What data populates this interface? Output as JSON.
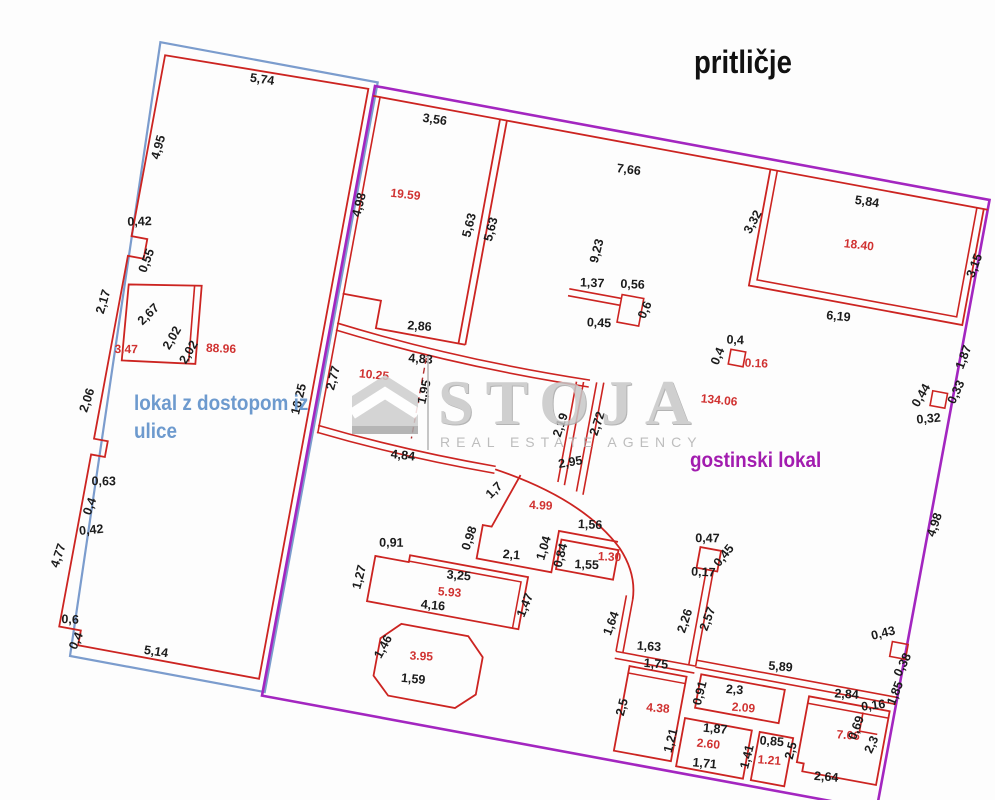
{
  "title": "pritličje",
  "units": {
    "left_line1": "lokal z dostopom iz",
    "left_line2": "ulice",
    "right": "gostinski lokal"
  },
  "watermark": {
    "name": "STOJA",
    "tagline": "REAL ESTATE AGENCY",
    "house_icon": "house-icon"
  },
  "colors": {
    "wall-red": "#cc2421",
    "outline-purple": "#a326c0",
    "outline-blue": "#7b9ccd",
    "dim-color": "#1b1b1b",
    "area-red": "#d03231",
    "blue-text": "#6d9ace",
    "purple-text": "#a21caf",
    "wm-gray": "#c7c7c7"
  },
  "plan_labels": [
    {
      "t": "5,74",
      "x": -112,
      "y": 18,
      "r": -2,
      "c": "d"
    },
    {
      "t": "4,95",
      "x": -198,
      "y": 100,
      "r": -85,
      "c": "d"
    },
    {
      "t": "0,42",
      "x": -206,
      "y": 180,
      "r": -12,
      "c": "d"
    },
    {
      "t": "0,55",
      "x": -189,
      "y": 214,
      "r": -80,
      "c": "d"
    },
    {
      "t": "2,17",
      "x": -224,
      "y": 262,
      "r": -84,
      "c": "d"
    },
    {
      "t": "2,67",
      "x": -178,
      "y": 268,
      "r": -55,
      "c": "d"
    },
    {
      "t": "2,02",
      "x": -150,
      "y": 286,
      "r": -70,
      "c": "d"
    },
    {
      "t": "2,02",
      "x": -131,
      "y": 297,
      "r": -70,
      "c": "d"
    },
    {
      "t": "3.47",
      "x": -196,
      "y": 308,
      "r": -10,
      "c": "a"
    },
    {
      "t": "88.96",
      "x": -103,
      "y": 290,
      "r": -8,
      "c": "a"
    },
    {
      "t": "2,06",
      "x": -222,
      "y": 362,
      "r": -82,
      "c": "d"
    },
    {
      "t": "0,63",
      "x": -194,
      "y": 442,
      "r": -10,
      "c": "d"
    },
    {
      "t": "0,4",
      "x": -200,
      "y": 466,
      "r": -80,
      "c": "d"
    },
    {
      "t": "0,42",
      "x": -197,
      "y": 492,
      "r": -16,
      "c": "d"
    },
    {
      "t": "4,77",
      "x": -222,
      "y": 520,
      "r": -82,
      "c": "d"
    },
    {
      "t": "0,6",
      "x": -202,
      "y": 584,
      "r": -8,
      "c": "d"
    },
    {
      "t": "0,4",
      "x": -189,
      "y": 601,
      "r": -76,
      "c": "d"
    },
    {
      "t": "5,14",
      "x": -112,
      "y": 600,
      "r": -2,
      "c": "d"
    },
    {
      "t": "16,25",
      "x": -14,
      "y": 322,
      "r": -87,
      "c": "d"
    },
    {
      "t": "3,56",
      "x": 65,
      "y": 26,
      "r": -2,
      "c": "d"
    },
    {
      "t": "4,98",
      "x": 10,
      "y": 120,
      "r": -86,
      "c": "d"
    },
    {
      "t": "19.59",
      "x": 50,
      "y": 105,
      "r": -4,
      "c": "a"
    },
    {
      "t": "5,63",
      "x": 122,
      "y": 120,
      "r": -86,
      "c": "d"
    },
    {
      "t": "5,63",
      "x": 144,
      "y": 120,
      "r": -86,
      "c": "d"
    },
    {
      "t": "2,86",
      "x": 88,
      "y": 232,
      "r": -6,
      "c": "d"
    },
    {
      "t": "7,66",
      "x": 265,
      "y": 40,
      "r": -3,
      "c": "d"
    },
    {
      "t": "5,84",
      "x": 505,
      "y": 28,
      "r": -2,
      "c": "d"
    },
    {
      "t": "3,32",
      "x": 400,
      "y": 66,
      "r": -72,
      "c": "d"
    },
    {
      "t": "18.40",
      "x": 505,
      "y": 72,
      "r": -4,
      "c": "a"
    },
    {
      "t": "3,15",
      "x": 626,
      "y": 68,
      "r": -80,
      "c": "d"
    },
    {
      "t": "6,19",
      "x": 498,
      "y": 146,
      "r": -5,
      "c": "d"
    },
    {
      "t": "1,87",
      "x": 632,
      "y": 160,
      "r": -80,
      "c": "d"
    },
    {
      "t": "0,33",
      "x": 631,
      "y": 196,
      "r": -76,
      "c": "d"
    },
    {
      "t": "0,44",
      "x": 597,
      "y": 206,
      "r": -70,
      "c": "d"
    },
    {
      "t": "0,32",
      "x": 606,
      "y": 230,
      "r": -16,
      "c": "d"
    },
    {
      "t": "4,98",
      "x": 634,
      "y": 330,
      "r": -82,
      "c": "d"
    },
    {
      "t": "1,37",
      "x": 250,
      "y": 158,
      "r": -8,
      "c": "d"
    },
    {
      "t": "0,56",
      "x": 290,
      "y": 152,
      "r": -8,
      "c": "d"
    },
    {
      "t": "0,6",
      "x": 310,
      "y": 172,
      "r": -76,
      "c": "d"
    },
    {
      "t": "0,45",
      "x": 264,
      "y": 196,
      "r": -8,
      "c": "d"
    },
    {
      "t": "9,23",
      "x": 252,
      "y": 122,
      "r": -86,
      "c": "d"
    },
    {
      "t": "0,4",
      "x": 401,
      "y": 188,
      "r": -8,
      "c": "d"
    },
    {
      "t": "0,4",
      "x": 390,
      "y": 204,
      "r": -78,
      "c": "d"
    },
    {
      "t": "0.16",
      "x": 426,
      "y": 207,
      "r": -8,
      "c": "a"
    },
    {
      "t": "134.06",
      "x": 396,
      "y": 250,
      "r": -5,
      "c": "a"
    },
    {
      "t": "2,77",
      "x": 16,
      "y": 295,
      "r": -86,
      "c": "d"
    },
    {
      "t": "10.25",
      "x": 52,
      "y": 288,
      "r": -5,
      "c": "a"
    },
    {
      "t": "4,83",
      "x": 95,
      "y": 264,
      "r": -6,
      "c": "d"
    },
    {
      "t": "1,95",
      "x": 108,
      "y": 292,
      "r": -87,
      "c": "d"
    },
    {
      "t": "2,19",
      "x": 248,
      "y": 300,
      "r": -82,
      "c": "d"
    },
    {
      "t": "2,72",
      "x": 284,
      "y": 292,
      "r": -82,
      "c": "d"
    },
    {
      "t": "4,84",
      "x": 95,
      "y": 362,
      "r": -4,
      "c": "d"
    },
    {
      "t": "1,7",
      "x": 194,
      "y": 378,
      "r": -55,
      "c": "d"
    },
    {
      "t": "2,95",
      "x": 262,
      "y": 338,
      "r": -20,
      "c": "d"
    },
    {
      "t": "4.99",
      "x": 240,
      "y": 386,
      "r": -8,
      "c": "a"
    },
    {
      "t": "1,56",
      "x": 292,
      "y": 396,
      "r": -8,
      "c": "d"
    },
    {
      "t": "0,98",
      "x": 179,
      "y": 428,
      "r": -82,
      "c": "d"
    },
    {
      "t": "2,1",
      "x": 220,
      "y": 440,
      "r": -6,
      "c": "d"
    },
    {
      "t": "1,04",
      "x": 254,
      "y": 424,
      "r": -84,
      "c": "d"
    },
    {
      "t": "0,84",
      "x": 272,
      "y": 428,
      "r": -86,
      "c": "d"
    },
    {
      "t": "1,55",
      "x": 296,
      "y": 436,
      "r": -8,
      "c": "d"
    },
    {
      "t": "1.30",
      "x": 317,
      "y": 424,
      "r": -8,
      "c": "a"
    },
    {
      "t": "0,91",
      "x": 100,
      "y": 450,
      "r": -10,
      "c": "d"
    },
    {
      "t": "3,25",
      "x": 172,
      "y": 470,
      "r": -6,
      "c": "d"
    },
    {
      "t": "5.93",
      "x": 166,
      "y": 488,
      "r": -6,
      "c": "a"
    },
    {
      "t": "4,16",
      "x": 152,
      "y": 504,
      "r": -5,
      "c": "d"
    },
    {
      "t": "1,47",
      "x": 246,
      "y": 484,
      "r": -78,
      "c": "d"
    },
    {
      "t": "1,27",
      "x": 78,
      "y": 486,
      "r": -86,
      "c": "d"
    },
    {
      "t": "1,46",
      "x": 114,
      "y": 551,
      "r": -72,
      "c": "d"
    },
    {
      "t": "3.95",
      "x": 150,
      "y": 556,
      "r": -8,
      "c": "a"
    },
    {
      "t": "1,59",
      "x": 146,
      "y": 580,
      "r": -5,
      "c": "d"
    },
    {
      "t": "1,64",
      "x": 334,
      "y": 486,
      "r": -80,
      "c": "d"
    },
    {
      "t": "1,63",
      "x": 372,
      "y": 505,
      "r": -7,
      "c": "d"
    },
    {
      "t": "0,47",
      "x": 410,
      "y": 388,
      "r": -10,
      "c": "d"
    },
    {
      "t": "0,45",
      "x": 432,
      "y": 400,
      "r": -62,
      "c": "d"
    },
    {
      "t": "0,17",
      "x": 412,
      "y": 422,
      "r": -8,
      "c": "d"
    },
    {
      "t": "2,26",
      "x": 406,
      "y": 470,
      "r": -82,
      "c": "d"
    },
    {
      "t": "2,57",
      "x": 428,
      "y": 464,
      "r": -80,
      "c": "d"
    },
    {
      "t": "1,75",
      "x": 382,
      "y": 521,
      "r": -6,
      "c": "d"
    },
    {
      "t": "2,5",
      "x": 360,
      "y": 566,
      "r": -86,
      "c": "d"
    },
    {
      "t": "4.38",
      "x": 392,
      "y": 564,
      "r": -6,
      "c": "a"
    },
    {
      "t": "5,89",
      "x": 505,
      "y": 501,
      "r": -6,
      "c": "d"
    },
    {
      "t": "0,91",
      "x": 434,
      "y": 538,
      "r": -86,
      "c": "d"
    },
    {
      "t": "2,3",
      "x": 464,
      "y": 532,
      "r": -6,
      "c": "d"
    },
    {
      "t": "2.09",
      "x": 476,
      "y": 548,
      "r": -6,
      "c": "a"
    },
    {
      "t": "1,21",
      "x": 414,
      "y": 590,
      "r": -86,
      "c": "d"
    },
    {
      "t": "1,87",
      "x": 452,
      "y": 574,
      "r": -5,
      "c": "d"
    },
    {
      "t": "2.60",
      "x": 448,
      "y": 590,
      "r": -5,
      "c": "a"
    },
    {
      "t": "1,41",
      "x": 492,
      "y": 592,
      "r": -86,
      "c": "d"
    },
    {
      "t": "1,71",
      "x": 448,
      "y": 610,
      "r": -5,
      "c": "d"
    },
    {
      "t": "0,85",
      "x": 510,
      "y": 576,
      "r": -6,
      "c": "d"
    },
    {
      "t": "1.21",
      "x": 511,
      "y": 595,
      "r": -6,
      "c": "a"
    },
    {
      "t": "2,5",
      "x": 534,
      "y": 578,
      "r": -86,
      "c": "d"
    },
    {
      "t": "2,84",
      "x": 575,
      "y": 516,
      "r": -7,
      "c": "d"
    },
    {
      "t": "7.06",
      "x": 584,
      "y": 556,
      "r": -6,
      "c": "a"
    },
    {
      "t": "2,3",
      "x": 612,
      "y": 558,
      "r": -76,
      "c": "d"
    },
    {
      "t": "2,64",
      "x": 570,
      "y": 601,
      "r": -6,
      "c": "d"
    },
    {
      "t": "0,43",
      "x": 601,
      "y": 449,
      "r": -24,
      "c": "d"
    },
    {
      "t": "0,38",
      "x": 628,
      "y": 474,
      "r": -74,
      "c": "d"
    },
    {
      "t": "1,85",
      "x": 626,
      "y": 503,
      "r": -79,
      "c": "d"
    },
    {
      "t": "0,16",
      "x": 604,
      "y": 522,
      "r": -18,
      "c": "d"
    },
    {
      "t": "0,69",
      "x": 594,
      "y": 544,
      "r": -80,
      "c": "d"
    }
  ]
}
